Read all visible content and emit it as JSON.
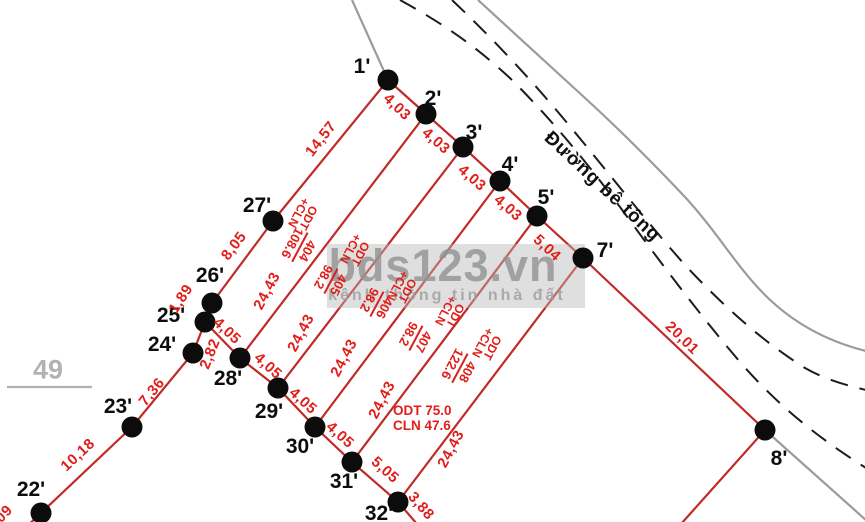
{
  "watermark": {
    "brand": "bds123.vn",
    "tagline": "kênh thông tin nhà đất"
  },
  "road": {
    "name": "Đường bê tông"
  },
  "adjacent_lot": {
    "label": "49"
  },
  "landuse_note": {
    "line1": "ODT 75.0",
    "line2": "CLN 47.6"
  },
  "colors": {
    "boundary_red": "#c22a26",
    "label_red": "#e01e1a",
    "road_gray": "#9b9b9b",
    "dashed_black": "#1c1c1c",
    "watermark_gray": "#919191"
  },
  "points": [
    {
      "label": "1'"
    },
    {
      "label": "2'"
    },
    {
      "label": "3'"
    },
    {
      "label": "4'"
    },
    {
      "label": "5'"
    },
    {
      "label": "7'"
    },
    {
      "label": "8'"
    },
    {
      "label": "22'"
    },
    {
      "label": "23'"
    },
    {
      "label": "24'"
    },
    {
      "label": "25'"
    },
    {
      "label": "26'"
    },
    {
      "label": "27'"
    },
    {
      "label": "28'"
    },
    {
      "label": "29'"
    },
    {
      "label": "30'"
    },
    {
      "label": "31'"
    },
    {
      "label": "32'"
    }
  ],
  "measurements": [
    {
      "text": "4,03"
    },
    {
      "text": "4,03"
    },
    {
      "text": "4,03"
    },
    {
      "text": "4,03"
    },
    {
      "text": "5,04"
    },
    {
      "text": "20,01"
    },
    {
      "text": "14,57"
    },
    {
      "text": "8,05"
    },
    {
      "text": "1,89"
    },
    {
      "text": "2,82"
    },
    {
      "text": "7,36"
    },
    {
      "text": "10,18"
    },
    {
      "text": "09"
    },
    {
      "text": "4,05"
    },
    {
      "text": "4,05"
    },
    {
      "text": "4,05"
    },
    {
      "text": "4,05"
    },
    {
      "text": "5,05"
    },
    {
      "text": "3,88"
    },
    {
      "text": "24,43"
    },
    {
      "text": "24,43"
    },
    {
      "text": "24,43"
    },
    {
      "text": "24,43"
    },
    {
      "text": "24,43"
    }
  ],
  "parcels": [
    {
      "use_top": "ODT",
      "use_bottom": "+CLN",
      "number": "404",
      "area": "108.6"
    },
    {
      "use_top": "ODT",
      "use_bottom": "+CLN",
      "number": "405",
      "area": "98.2"
    },
    {
      "use_top": "ODT",
      "use_bottom": "+CLN",
      "number": "406",
      "area": "98.2"
    },
    {
      "use_top": "ODT",
      "use_bottom": "+CLN",
      "number": "407",
      "area": "98.2"
    },
    {
      "use_top": "ODT",
      "use_bottom": "+CLN",
      "number": "408",
      "area": "122.6"
    }
  ]
}
